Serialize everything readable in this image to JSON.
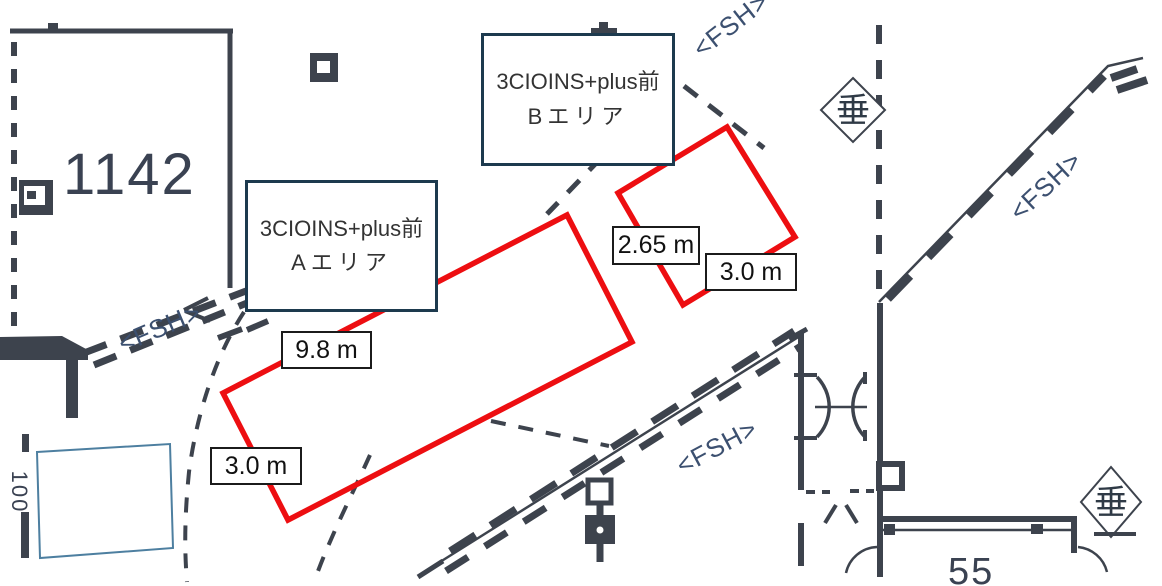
{
  "canvas": {
    "width": 1162,
    "height": 586,
    "background": "#ffffff"
  },
  "colors": {
    "wall_line": "#3d434d",
    "area_outline_red": "#ed0e11",
    "fsh_text": "#3c5070",
    "blue_rect": "#4d7fa0",
    "label_box_border": "#1d3a4e",
    "cad_number_text": "#3a4252"
  },
  "labels": {
    "area_b": {
      "line1": "3CIOINS+plus前",
      "line2": "Bエリア"
    },
    "area_a": {
      "line1": "3CIOINS+plus前",
      "line2": "Aエリア"
    },
    "dim_b_width": "2.65 m",
    "dim_b_depth": "3.0 m",
    "dim_a_width": "9.8 m",
    "dim_a_depth": "3.0 m",
    "room_number_large": "1142",
    "room_number_partial": "55",
    "margin_text": "100",
    "fsh": "<FSH>",
    "plumb_symbol": "垂"
  }
}
